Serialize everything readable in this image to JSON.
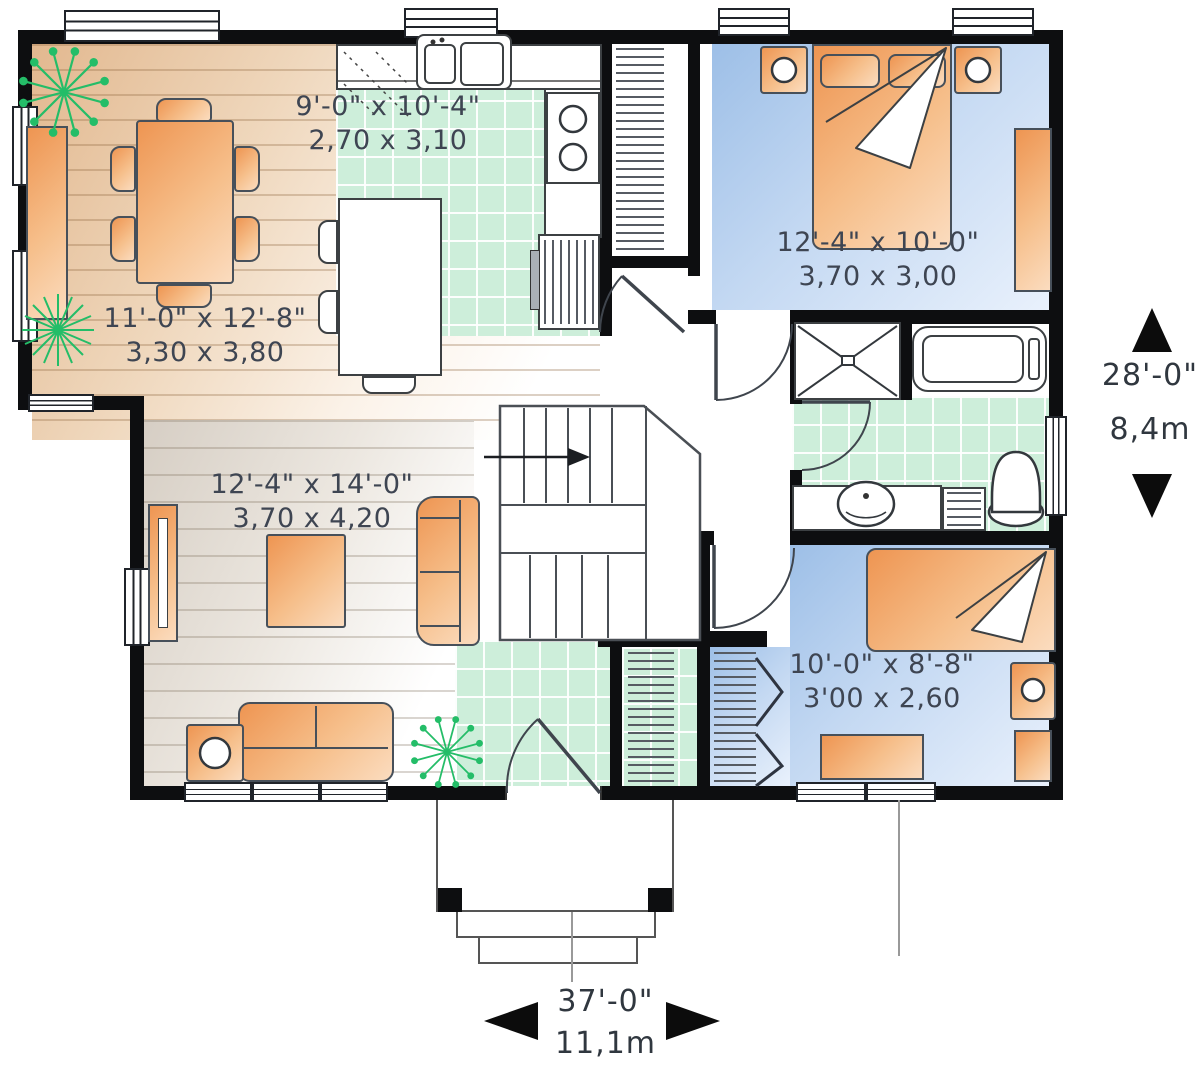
{
  "title": "single-storey house floor plan",
  "rooms": {
    "kitchen": {
      "imperial": "9'-0\" x 10'-4\"",
      "metric": "2,70 x 3,10"
    },
    "dining": {
      "imperial": "11'-0\" x 12'-8\"",
      "metric": "3,30 x 3,80"
    },
    "master_bedroom": {
      "imperial": "12'-4\" x 10'-0\"",
      "metric": "3,70 x 3,00"
    },
    "living_room": {
      "imperial": "12'-4\" x 14'-0\"",
      "metric": "3,70 x 4,20"
    },
    "bedroom_2": {
      "imperial": "10'-0\" x 8'-8\"",
      "metric": "3'00 x 2,60"
    }
  },
  "overall_dimensions": {
    "depth": {
      "imperial": "28'-0\"",
      "metric": "8,4m"
    },
    "width": {
      "imperial": "37'-0\"",
      "metric": "11,1m"
    }
  },
  "colors": {
    "wall": "#0d0e10",
    "furniture_orange": "#ee9552",
    "tile_green": "#cdeeda",
    "bedroom_blue": "#9dbfe7",
    "plant_green": "#24bd68"
  },
  "icons": {
    "north_up_arrow": "filled triangle up",
    "south_down_arrow": "filled triangle down",
    "west_left_arrow": "filled triangle left",
    "east_right_arrow": "filled triangle right"
  }
}
